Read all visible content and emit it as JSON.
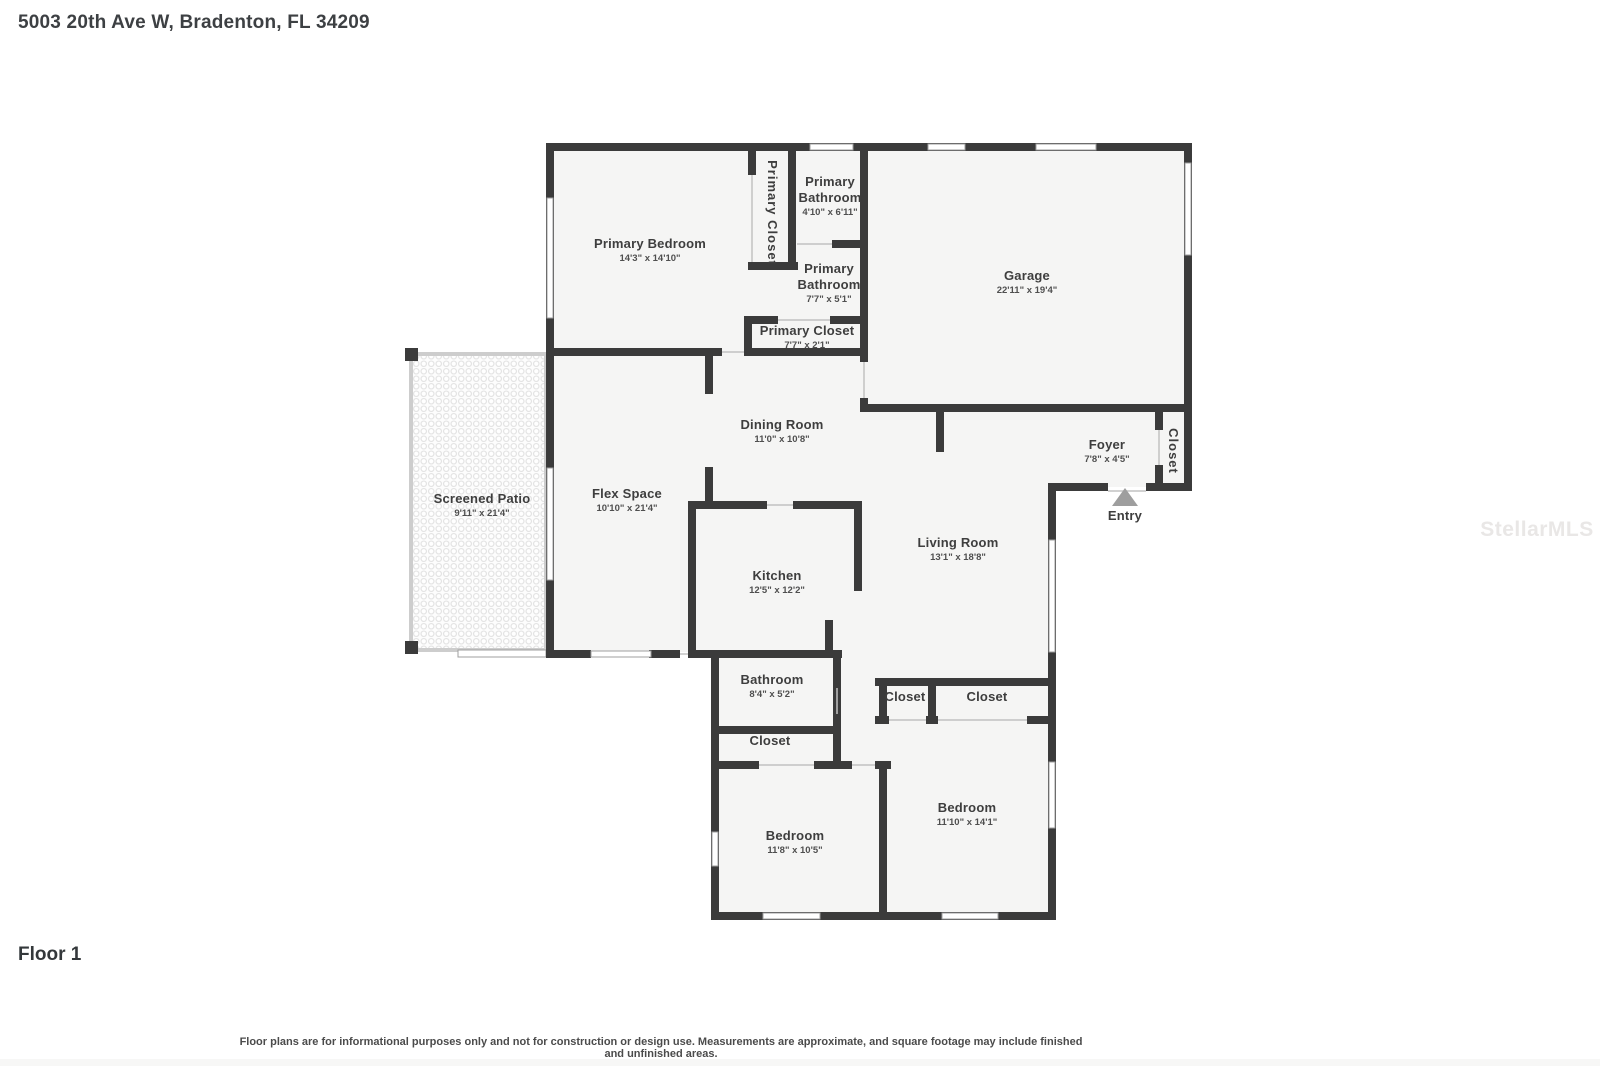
{
  "page": {
    "address_title": "5003 20th Ave W, Bradenton, FL 34209",
    "floor_label": "Floor 1",
    "disclaimer": "Floor plans are for informational purposes only and not for construction or design use. Measurements are approximate, and square footage may include finished and unfinished areas.",
    "watermark": "StellarMLS"
  },
  "floor_plan": {
    "rooms": [
      {
        "name": "Primary Bedroom",
        "dims": "14'3\" x 14'10\""
      },
      {
        "name": "Primary Closet",
        "dims": ""
      },
      {
        "name": "Primary Bathroom",
        "dims": "4'10\" x 6'11\""
      },
      {
        "name": "Primary Bathroom",
        "dims": "7'7\" x 5'1\""
      },
      {
        "name": "Primary Closet",
        "dims": "7'7\" x 2'1\""
      },
      {
        "name": "Garage",
        "dims": "22'11\" x 19'4\""
      },
      {
        "name": "Screened Patio",
        "dims": "9'11\" x 21'4\""
      },
      {
        "name": "Flex Space",
        "dims": "10'10\" x 21'4\""
      },
      {
        "name": "Dining Room",
        "dims": "11'0\" x 10'8\""
      },
      {
        "name": "Kitchen",
        "dims": "12'5\" x 12'2\""
      },
      {
        "name": "Living Room",
        "dims": "13'1\" x 18'8\""
      },
      {
        "name": "Foyer",
        "dims": "7'8\" x 4'5\""
      },
      {
        "name": "Closet",
        "dims": ""
      },
      {
        "name": "Bathroom",
        "dims": "8'4\" x 5'2\""
      },
      {
        "name": "Closet",
        "dims": ""
      },
      {
        "name": "Closet",
        "dims": ""
      },
      {
        "name": "Closet",
        "dims": ""
      },
      {
        "name": "Bedroom",
        "dims": "11'8\" x 10'5\""
      },
      {
        "name": "Bedroom",
        "dims": "11'10\" x 14'1\""
      },
      {
        "name": "Entry",
        "dims": ""
      }
    ],
    "colors": {
      "wall": "#3b3b3b",
      "room_fill": "#f5f5f4",
      "window_stroke": "#9f9f9f",
      "entry_arrow": "#9e9e9e"
    }
  }
}
